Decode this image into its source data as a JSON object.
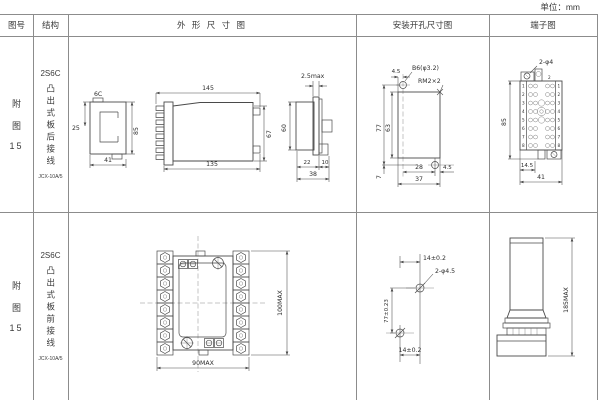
{
  "unit_label": "单位：mm",
  "header": {
    "fig_no": "图号",
    "structure": "结构",
    "outline": "外 形 尺 寸 图",
    "install": "安装开孔尺寸图",
    "terminal": "端子图"
  },
  "rows": [
    {
      "fig": {
        "char1": "附",
        "char2": "图",
        "num": "15"
      },
      "structure": {
        "model": "2S6C",
        "mount": "凸出式板后接线",
        "relay_code": "JCX-10A/5"
      },
      "outline": {
        "view_label": "6C",
        "d_25": "25",
        "d_85": "85",
        "d_41": "41",
        "d_145": "145",
        "d_135": "135",
        "d_67": "67",
        "d_25max": "2.5max",
        "d_60": "60",
        "d_22": "22",
        "d_10": "10",
        "d_38": "38"
      },
      "install": {
        "d_45_top": "4.5",
        "hole_spec": "B6(φ3.2)",
        "thread_spec": "RM2×2",
        "d_77": "77",
        "d_63": "63",
        "d_7": "7",
        "d_28": "28",
        "d_37": "37",
        "d_45_right": "4.5"
      },
      "terminal": {
        "hole_spec": "2-φ4",
        "top_label": "2",
        "d_85": "85",
        "d_14_5": "14.5",
        "d_41": "41",
        "pins": [
          "1",
          "2",
          "3",
          "4",
          "5",
          "6",
          "7",
          "8"
        ]
      }
    },
    {
      "fig": {
        "char1": "附",
        "char2": "图",
        "num": "15"
      },
      "structure": {
        "model": "2S6C",
        "mount": "凸出式板前接线",
        "relay_code": "JCX-10A/5"
      },
      "outline": {
        "d_height": "100MAX",
        "d_width": "90MAX"
      },
      "install": {
        "d_top": "14±0.2",
        "hole_spec": "2-φ4.5",
        "d_height": "77±0.23",
        "d_bottom": "14±0.2"
      },
      "terminal": {
        "d_height": "185MAX"
      }
    }
  ]
}
